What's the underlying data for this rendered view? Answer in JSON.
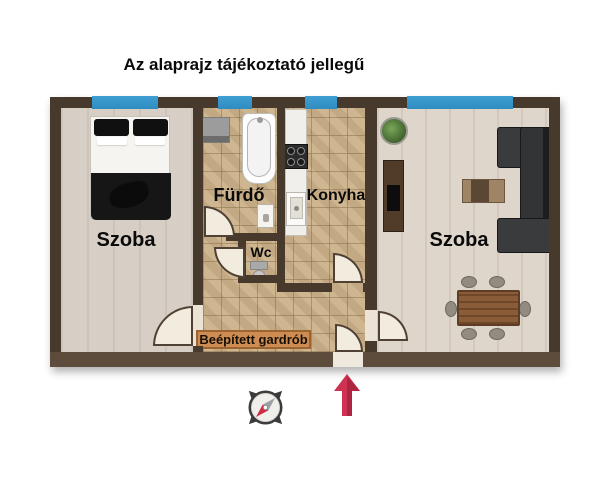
{
  "title": "Az alaprajz tájékoztató jellegű",
  "rooms": {
    "bedroom": {
      "label": "Szoba"
    },
    "bathroom": {
      "label": "Fürdő"
    },
    "kitchen": {
      "label": "Konyha"
    },
    "wc": {
      "label": "Wc"
    },
    "living": {
      "label": "Szoba"
    },
    "wardrobe": {
      "label": "Beépített gardrób"
    }
  },
  "icons": {
    "compass": "compass-rose-icon",
    "north_arrow": "north-arrow-icon"
  },
  "colors": {
    "wall": "#47392c",
    "wall_bottom": "#5d4b3c",
    "window": "#3f9ed2",
    "tile": "#ccb28a",
    "wood": "#d7cfc6",
    "wood_living": "#ded5cb",
    "door": "#f2ecdf",
    "gardrob": "#cf8c52",
    "arrow": "#cf3152",
    "needle_red": "#cf2b44",
    "needle_gray": "#9aa0a3"
  }
}
